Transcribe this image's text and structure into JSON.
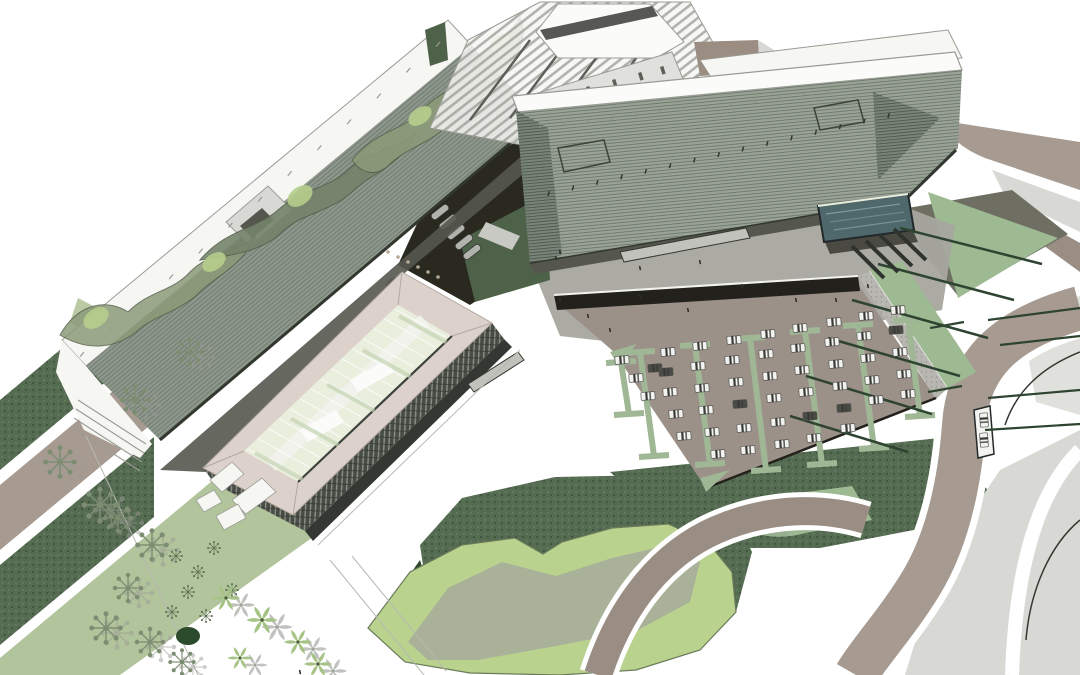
{
  "scene": {
    "name": "aerial-architectural-site-rendering",
    "palette": {
      "paper": "#ffffff",
      "louver_a_base": "#8e978c",
      "louver_a_line": "#6d786d",
      "louver_c_base": "#99a295",
      "louver_c_line": "#6b766b",
      "louver_dark_base": "#7a857a",
      "louver_dark_line": "#4d584d",
      "white_roof": "#f6f6f3",
      "white_bright": "#fbfbf9",
      "edge_gray": "#9b9b95",
      "eave_dark": "#33382f",
      "pink_roof": "#dcd2cb",
      "pink_line": "#b2a8a0",
      "atrium_glass": "#e9eedd",
      "atrium_green": "#c6d5b5",
      "atrium_dark_edge": "#3c423c",
      "facade_dark": "#474c45",
      "facade_light": "#8b8f86",
      "facade_line": "#343832",
      "shadow_band": "#55564e",
      "service_dark": "#29291f",
      "service_green": "#4e6249",
      "plaza_gray": "#a7a69f",
      "olive_shadow": "#6e6e62",
      "under_pool_shadow": "#4a4a42",
      "pool_teal": "#4f686c",
      "pool_rim": "#23292a",
      "pool_light": "#8aa3a6",
      "crosswalk": "#2f332e",
      "asphalt": "#9c9189",
      "wall_dark": "#23211c",
      "gabion": "#b8b6b0",
      "gabion_dot": "#94928c",
      "coping": "#f2f2ee",
      "divider_green": "#9fb795",
      "road_taupe": "#a79b91",
      "road_taupe2": "#998d84",
      "plaza_light": "#d8d8d5",
      "plaza_lighter": "#e0e0dd",
      "green_triangle": "#9dba93",
      "hedge_dark": "#2e4430",
      "dark_green_tex": "#566c52",
      "dark_green_dot": "#688161",
      "dark_green_deep": "#31462f",
      "pale_green": "#b2c49b",
      "lawn_light": "#b9d38f",
      "lawn_edge": "#6b7b5a",
      "plateau": "#a8ae9a",
      "canopy_sage": "#8c9b79",
      "canopy_gray": "#75836b",
      "canopy_light": "#b7cf8d",
      "canopy_line": "#55614c",
      "tree_sage": "#7d8d72",
      "tree_dark": "#5c6e52",
      "tree_shadow": "#9a9a94",
      "palm_green": "#a6c386",
      "palm_shadow": "#8f8f8a",
      "evergreen": "#2c4a2c",
      "car_white": "#f2f2f0",
      "car_dark": "#4a4a46",
      "car_glass": "#3a3a36",
      "bench": "#c2c2bc",
      "kiosk_white": "#f4f4f1",
      "people": "#2e2e2a",
      "pergola_line": "#9a9a93",
      "pergola_dark": "#5f5f5a",
      "wedge_taupe": "#9b8d82",
      "sketch": "#b8b8b2",
      "bollard": "#b5a894",
      "truck": "#b3b3ad",
      "ramp_light": "#c9c9c3",
      "bush_gray": "#8a8d84"
    },
    "cars": [
      [
        622,
        360,
        0
      ],
      [
        636,
        378,
        0
      ],
      [
        648,
        396,
        0
      ],
      [
        655,
        368,
        1
      ],
      [
        668,
        352,
        0
      ],
      [
        666,
        372,
        1
      ],
      [
        670,
        392,
        0
      ],
      [
        676,
        414,
        0
      ],
      [
        684,
        436,
        0
      ],
      [
        700,
        346,
        0
      ],
      [
        698,
        366,
        0
      ],
      [
        702,
        388,
        0
      ],
      [
        706,
        410,
        0
      ],
      [
        712,
        432,
        0
      ],
      [
        718,
        454,
        0
      ],
      [
        734,
        340,
        0
      ],
      [
        732,
        360,
        0
      ],
      [
        736,
        382,
        0
      ],
      [
        740,
        404,
        1
      ],
      [
        744,
        428,
        0
      ],
      [
        748,
        450,
        0
      ],
      [
        768,
        334,
        0
      ],
      [
        766,
        354,
        0
      ],
      [
        770,
        376,
        0
      ],
      [
        774,
        398,
        0
      ],
      [
        778,
        422,
        0
      ],
      [
        782,
        444,
        0
      ],
      [
        800,
        328,
        0
      ],
      [
        798,
        348,
        0
      ],
      [
        802,
        370,
        0
      ],
      [
        806,
        392,
        0
      ],
      [
        810,
        416,
        1
      ],
      [
        814,
        438,
        0
      ],
      [
        834,
        322,
        0
      ],
      [
        832,
        342,
        0
      ],
      [
        836,
        364,
        0
      ],
      [
        840,
        386,
        0
      ],
      [
        844,
        408,
        1
      ],
      [
        848,
        428,
        0
      ],
      [
        866,
        316,
        0
      ],
      [
        864,
        336,
        0
      ],
      [
        868,
        358,
        0
      ],
      [
        872,
        380,
        0
      ],
      [
        876,
        400,
        0
      ],
      [
        898,
        310,
        0
      ],
      [
        896,
        330,
        1
      ],
      [
        900,
        352,
        0
      ],
      [
        904,
        374,
        0
      ],
      [
        908,
        394,
        0
      ]
    ],
    "kiosk_cars": [
      [
        984,
        420
      ],
      [
        984,
        440
      ]
    ],
    "parking_dividers": [
      [
        640,
        352,
        654,
        456
      ],
      [
        695,
        345,
        710,
        464
      ],
      [
        750,
        338,
        766,
        470
      ],
      [
        805,
        331,
        822,
        464
      ],
      [
        858,
        325,
        874,
        448
      ],
      [
        908,
        320,
        920,
        416
      ],
      [
        621,
        362,
        629,
        414
      ]
    ],
    "tick_rows": [
      {
        "p": [
          84,
          352,
          440,
          42
        ],
        "n": 13,
        "len": 6,
        "ang": 130,
        "key": "edge_gray",
        "w": 1.2
      },
      {
        "p": [
          548,
          196,
          888,
          118
        ],
        "n": 15,
        "len": 5,
        "ang": -75,
        "key": "eave_dark",
        "w": 1.5
      },
      {
        "p": [
          540,
          128,
          898,
          86
        ],
        "n": 16,
        "len": 4,
        "ang": -75,
        "key": "facade_light",
        "w": 1.2
      },
      {
        "p": [
          395,
          309,
          248,
          449
        ],
        "n": 15,
        "len": 58,
        "ang": 29,
        "key": "white_bright",
        "w": 1.1,
        "op": 0.92
      },
      {
        "p": [
          399,
          316,
          255,
          453
        ],
        "n": 5,
        "len": 54,
        "ang": 29,
        "key": "atrium_green",
        "w": 4,
        "op": 0.75
      }
    ],
    "lines": [
      {
        "s": [
          78,
          400,
          146,
          444
        ],
        "key": "edge_gray",
        "w": 1.1
      },
      {
        "s": [
          76,
          409,
          144,
          453
        ],
        "key": "edge_gray",
        "w": 1.1
      },
      {
        "s": [
          74,
          418,
          142,
          462
        ],
        "key": "edge_gray",
        "w": 1.1
      },
      {
        "s": [
          72,
          427,
          140,
          471
        ],
        "key": "edge_gray",
        "w": 1.1
      },
      {
        "s": [
          86,
          436,
          198,
          675
        ],
        "key": "sketch",
        "w": 1
      },
      {
        "s": [
          330,
          560,
          424,
          675
        ],
        "key": "sketch",
        "w": 1
      },
      {
        "s": [
          352,
          556,
          446,
          671
        ],
        "key": "sketch",
        "w": 1
      },
      {
        "s": [
          318,
          545,
          520,
          350
        ],
        "key": "sketch",
        "w": 1
      },
      {
        "s": [
          900,
          228,
          1042,
          264
        ],
        "key": "hedge_dark",
        "w": 2.5
      },
      {
        "s": [
          878,
          264,
          1014,
          300
        ],
        "key": "hedge_dark",
        "w": 2.5
      },
      {
        "s": [
          852,
          300,
          988,
          338
        ],
        "key": "hedge_dark",
        "w": 2.5
      },
      {
        "s": [
          828,
          338,
          960,
          376
        ],
        "key": "hedge_dark",
        "w": 2.5
      },
      {
        "s": [
          806,
          376,
          932,
          414
        ],
        "key": "hedge_dark",
        "w": 2.5
      },
      {
        "s": [
          790,
          416,
          908,
          452
        ],
        "key": "hedge_dark",
        "w": 2.5
      },
      {
        "s": [
          988,
          320,
          1080,
          308
        ],
        "key": "hedge_dark",
        "w": 2.2
      },
      {
        "s": [
          1000,
          345,
          1080,
          336
        ],
        "key": "hedge_dark",
        "w": 2.2
      },
      {
        "s": [
          988,
          398,
          1080,
          390
        ],
        "key": "hedge_dark",
        "w": 2.2
      },
      {
        "s": [
          985,
          430,
          1080,
          424
        ],
        "key": "hedge_dark",
        "w": 2.2
      },
      {
        "s": [
          930,
          328,
          964,
          322
        ],
        "key": "hedge_dark",
        "w": 2.2
      },
      {
        "s": [
          928,
          392,
          962,
          386
        ],
        "key": "hedge_dark",
        "w": 2.2
      },
      {
        "s": [
          852,
          246,
          884,
          278
        ],
        "key": "crosswalk",
        "w": 4
      },
      {
        "s": [
          866,
          241,
          898,
          272
        ],
        "key": "crosswalk",
        "w": 4
      },
      {
        "s": [
          880,
          235,
          912,
          266
        ],
        "key": "crosswalk",
        "w": 4
      },
      {
        "s": [
          894,
          229,
          926,
          260
        ],
        "key": "crosswalk",
        "w": 4
      },
      {
        "s": [
          826,
          214,
          900,
          204
        ],
        "key": "pool_light",
        "w": 1.2,
        "op": 0.8
      },
      {
        "s": [
          830,
          222,
          904,
          212
        ],
        "key": "pool_light",
        "w": 1,
        "op": 0.6
      },
      {
        "s": [
          834,
          230,
          906,
          220
        ],
        "key": "pool_light",
        "w": 1.2,
        "op": 0.7
      }
    ],
    "people": [
      [
        560,
        300
      ],
      [
        588,
        316
      ],
      [
        640,
        296
      ],
      [
        688,
        310
      ],
      [
        742,
        286
      ],
      [
        796,
        300
      ],
      [
        700,
        262
      ],
      [
        640,
        268
      ],
      [
        556,
        258
      ],
      [
        610,
        330
      ],
      [
        836,
        300
      ],
      [
        868,
        286
      ],
      [
        300,
        672
      ],
      [
        560,
        252
      ]
    ],
    "bollards": [
      [
        388,
        252
      ],
      [
        398,
        257
      ],
      [
        408,
        262
      ],
      [
        418,
        267
      ],
      [
        428,
        272
      ],
      [
        438,
        277
      ]
    ],
    "star_trees": [
      [
        60,
        462,
        1.1
      ],
      [
        135,
        400,
        1.0
      ],
      [
        190,
        352,
        0.9
      ],
      [
        100,
        505,
        1.2
      ],
      [
        118,
        518,
        1.0
      ],
      [
        152,
        545,
        1.1
      ],
      [
        128,
        588,
        1.0
      ],
      [
        106,
        628,
        1.1
      ],
      [
        150,
        642,
        1.0
      ],
      [
        182,
        662,
        0.9
      ]
    ],
    "small_trees": [
      [
        176,
        556
      ],
      [
        198,
        572
      ],
      [
        188,
        592
      ],
      [
        214,
        548
      ],
      [
        172,
        612
      ],
      [
        206,
        616
      ],
      [
        232,
        590
      ]
    ],
    "palms": [
      [
        226,
        598,
        1.0
      ],
      [
        262,
        620,
        1.1
      ],
      [
        298,
        642,
        1.0
      ],
      [
        240,
        658,
        0.9
      ],
      [
        318,
        664,
        1.0
      ]
    ],
    "sketch_trees": [
      [
        640,
        98,
        10
      ],
      [
        682,
        108,
        12
      ],
      [
        724,
        92,
        9
      ]
    ],
    "trucks": [
      [
        448,
        222
      ],
      [
        456,
        232
      ],
      [
        464,
        242
      ],
      [
        472,
        252
      ],
      [
        440,
        212
      ]
    ]
  }
}
